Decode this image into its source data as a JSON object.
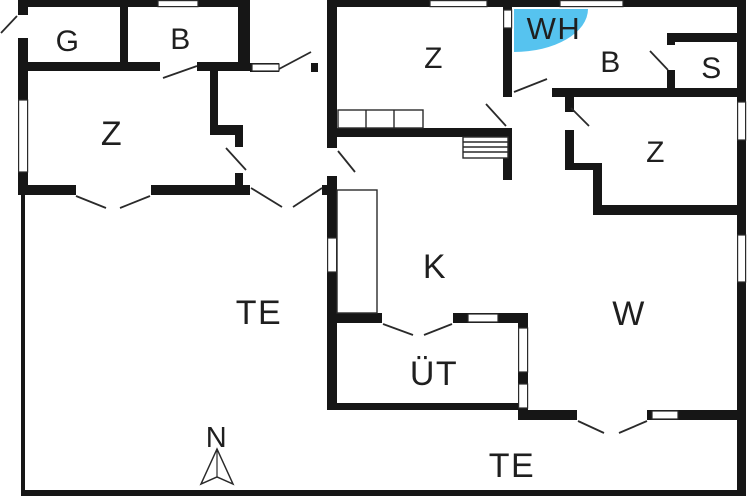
{
  "colors": {
    "wall": "#161616",
    "whirlpool_fill": "#56c3ef",
    "label_text": "#1f1f1f"
  },
  "labels": {
    "room_g": "G",
    "room_b_left": "B",
    "room_z_left": "Z",
    "room_z_middle": "Z",
    "whirlpool": "WH",
    "room_b_bath": "B",
    "room_s": "S",
    "room_z_right": "Z",
    "room_k": "K",
    "terrace_left": "TE",
    "covered_terrace": "ÜT",
    "room_w": "W",
    "terrace_bottom": "TE",
    "compass_north": "N"
  }
}
